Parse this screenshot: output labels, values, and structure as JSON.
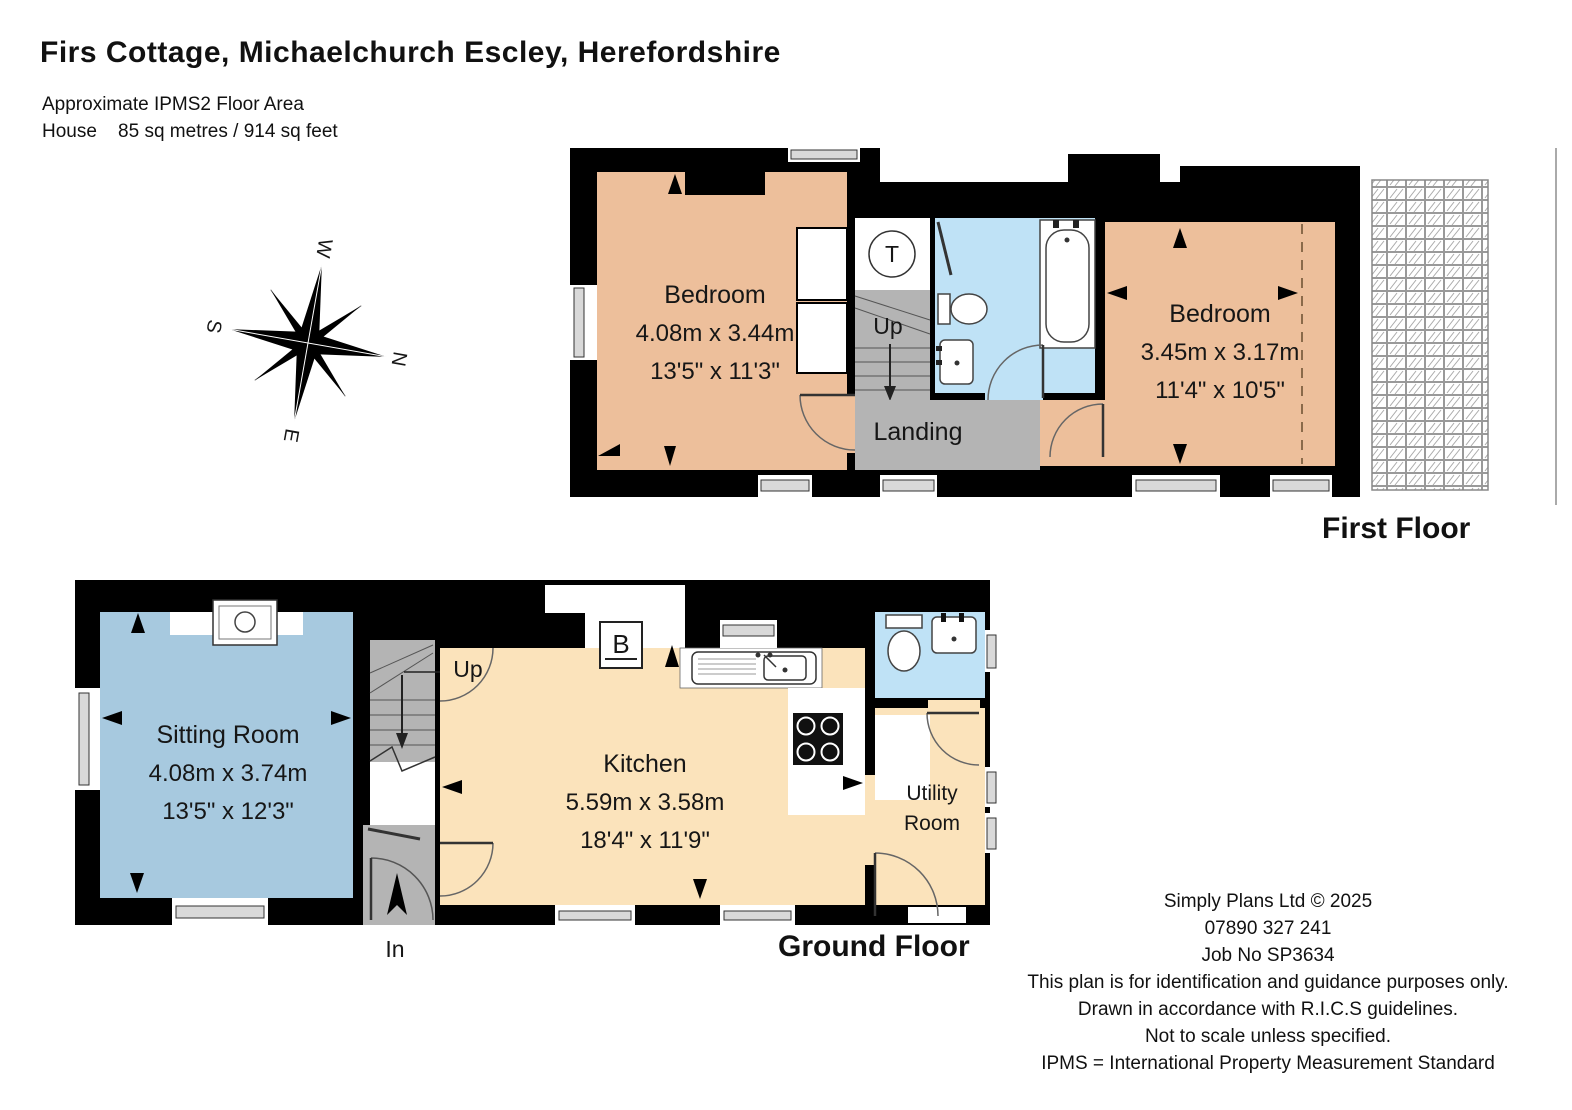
{
  "header": {
    "title": "Firs Cottage, Michaelchurch Escley, Herefordshire",
    "subtitle_line1": "Approximate IPMS2 Floor Area",
    "subtitle_line2": "House    85 sq metres / 914 sq feet"
  },
  "compass": {
    "n": "N",
    "s": "S",
    "e": "E",
    "w": "W"
  },
  "first_floor": {
    "label": "First Floor",
    "bedroom1": {
      "name": "Bedroom",
      "metric": "4.08m x 3.44m",
      "imperial": "13'5\" x 11'3\""
    },
    "bedroom2": {
      "name": "Bedroom",
      "metric": "3.45m x 3.17m",
      "imperial": "11'4\" x 10'5\""
    },
    "landing": {
      "name": "Landing"
    },
    "stairs_label": "Up",
    "tank_label": "T"
  },
  "ground_floor": {
    "label": "Ground Floor",
    "sitting_room": {
      "name": "Sitting Room",
      "metric": "4.08m x 3.74m",
      "imperial": "13'5\" x 12'3\""
    },
    "kitchen": {
      "name": "Kitchen",
      "metric": "5.59m x 3.58m",
      "imperial": "18'4\" x 11'9\""
    },
    "utility": {
      "name_line1": "Utility",
      "name_line2": "Room"
    },
    "stairs_label": "Up",
    "boiler_label": "B",
    "entrance_label": "In"
  },
  "footer": {
    "lines": [
      "Simply Plans Ltd © 2025",
      "07890 327 241",
      "Job No SP3634",
      "This plan is for identification and guidance purposes only.",
      "Drawn in accordance with R.I.C.S guidelines.",
      "Not to scale unless specified.",
      "IPMS = International Property Measurement Standard"
    ]
  },
  "colors": {
    "wall": "#000000",
    "bedroom_fill": "#edbf9b",
    "kitchen_fill": "#fbe3bb",
    "sitting_fill": "#a7c9df",
    "bath_fill": "#bfe2f6",
    "circulation_fill": "#b4b4b4"
  }
}
